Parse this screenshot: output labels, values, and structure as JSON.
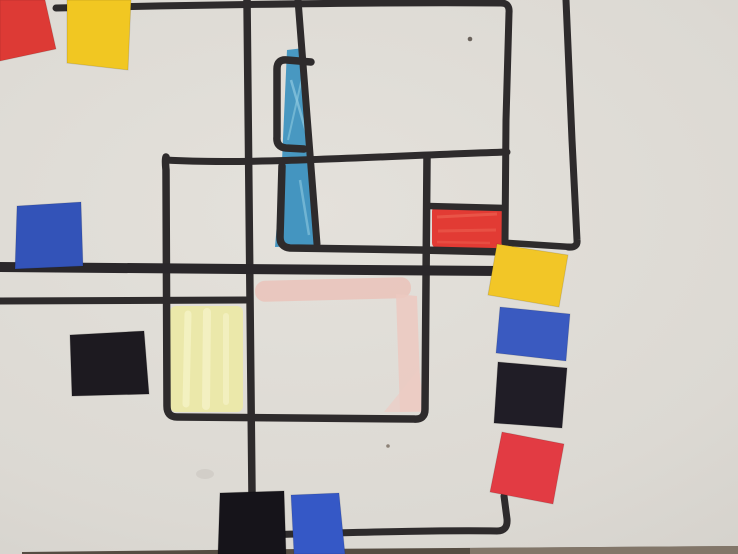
{
  "artwork": {
    "canvas": {
      "width": 738,
      "height": 554,
      "paper_base": "#dcd9d3",
      "vignette_edge": "#ccc9c3"
    },
    "palette": {
      "marker_line": "#2e2b2c",
      "paper_red": "#dd3a35",
      "paper_yellow": "#f1c722",
      "paper_blue": "#3353b8",
      "paper_black": "#1d1a20",
      "crayon_blue": "#3f93c0",
      "crayon_yellow": "#ebe8a6",
      "crayon_pink": "#eac4bb",
      "crayon_red": "#e1322b",
      "table_edge_dark": "#4e443a",
      "table_edge_light": "#8d8173"
    },
    "shapes": [
      {
        "name": "crayon-yellow-patch",
        "tag": "rect",
        "attrs": {
          "x": 170,
          "y": 306,
          "width": 73,
          "height": 106,
          "rx": 6,
          "fill": "#ebe8a6",
          "opacity": 0.92
        }
      },
      {
        "name": "crayon-yellow-streak",
        "tag": "path",
        "attrs": {
          "d": "M188,314 L186,404",
          "stroke": "#f5f2c6",
          "stroke-width": 7,
          "fill": "none",
          "opacity": 0.8,
          "stroke-linecap": "round"
        }
      },
      {
        "name": "crayon-yellow-streak",
        "tag": "path",
        "attrs": {
          "d": "M207,312 L206,406",
          "stroke": "#f6f3ca",
          "stroke-width": 8,
          "fill": "none",
          "opacity": 0.7,
          "stroke-linecap": "round"
        }
      },
      {
        "name": "crayon-yellow-streak",
        "tag": "path",
        "attrs": {
          "d": "M226,316 L226,402",
          "stroke": "#f5f2c6",
          "stroke-width": 6,
          "fill": "none",
          "opacity": 0.7,
          "stroke-linecap": "round"
        }
      },
      {
        "name": "crayon-blue-upper",
        "tag": "polygon",
        "attrs": {
          "points": "287,50 304,48 311,158 282,161",
          "fill": "#3f93c0",
          "opacity": 0.95
        }
      },
      {
        "name": "crayon-blue-lower",
        "tag": "polygon",
        "attrs": {
          "points": "282,163 312,161 320,245 275,247",
          "fill": "#3b90bf",
          "opacity": 0.95
        }
      },
      {
        "name": "crayon-blue-streak",
        "tag": "path",
        "attrs": {
          "d": "M291,80 L307,135",
          "stroke": "#8ec9e0",
          "stroke-width": 2.5,
          "fill": "none",
          "opacity": 0.7
        }
      },
      {
        "name": "crayon-blue-streak",
        "tag": "path",
        "attrs": {
          "d": "M305,65 L288,140",
          "stroke": "#8ec9e0",
          "stroke-width": 2,
          "fill": "none",
          "opacity": 0.6
        }
      },
      {
        "name": "crayon-blue-streak",
        "tag": "path",
        "attrs": {
          "d": "M300,180 L309,235",
          "stroke": "#8ec9e0",
          "stroke-width": 2.5,
          "fill": "none",
          "opacity": 0.6
        }
      },
      {
        "name": "crayon-pink-band",
        "tag": "rect",
        "attrs": {
          "x": 255,
          "y": 279,
          "width": 156,
          "height": 21,
          "rx": 10,
          "fill": "#eac4bb",
          "opacity": 0.9,
          "transform": "rotate(-1.5 333 289)"
        }
      },
      {
        "name": "crayon-pink-right-strip",
        "tag": "polygon",
        "attrs": {
          "points": "396,294 417,296 421,411 400,412",
          "fill": "#ecc9c1",
          "opacity": 0.85
        }
      },
      {
        "name": "crayon-pink-diagonal",
        "tag": "polygon",
        "attrs": {
          "points": "384,412 419,369 425,412",
          "fill": "#edccc4",
          "opacity": 0.7
        }
      },
      {
        "name": "crayon-red-patch",
        "tag": "rect",
        "attrs": {
          "x": 432,
          "y": 206,
          "width": 71,
          "height": 42,
          "rx": 5,
          "fill": "#e1322b",
          "opacity": 0.95
        }
      },
      {
        "name": "crayon-red-streak",
        "tag": "path",
        "attrs": {
          "d": "M437,217 L497,214",
          "stroke": "#ef6a58",
          "stroke-width": 3,
          "fill": "none",
          "opacity": 0.55
        }
      },
      {
        "name": "crayon-red-streak",
        "tag": "path",
        "attrs": {
          "d": "M438,231 L496,230",
          "stroke": "#ef6a58",
          "stroke-width": 3,
          "fill": "none",
          "opacity": 0.45
        }
      },
      {
        "name": "crayon-red-streak",
        "tag": "path",
        "attrs": {
          "d": "M437,242 L490,243",
          "stroke": "#ef6a58",
          "stroke-width": 2.5,
          "fill": "none",
          "opacity": 0.4
        }
      },
      {
        "name": "marker-top-border-and-right-vertical",
        "tag": "path",
        "attrs": {
          "d": "M56,8 C250,4 420,2 501,3 Q510,3 509,13 L506,120 L505,243",
          "stroke": "#2e2b2c",
          "stroke-width": 7,
          "fill": "none",
          "stroke-linecap": "round",
          "stroke-linejoin": "round"
        }
      },
      {
        "name": "marker-bottom-elbow-line",
        "tag": "path",
        "attrs": {
          "d": "M504,496 L507,519 Q508,531 497,531 C430,530 340,533 255,535",
          "stroke": "#2e2b2c",
          "stroke-width": 7,
          "fill": "none",
          "stroke-linecap": "round",
          "stroke-linejoin": "round"
        }
      },
      {
        "name": "marker-long-vertical-left",
        "tag": "path",
        "attrs": {
          "d": "M247,0 L252,494",
          "stroke": "#2e2b2c",
          "stroke-width": 7.5,
          "fill": "none",
          "stroke-linecap": "round"
        }
      },
      {
        "name": "marker-slanted-vertical-center",
        "tag": "path",
        "attrs": {
          "d": "M298,0 L317,244",
          "stroke": "#2e2b2c",
          "stroke-width": 7,
          "fill": "none",
          "stroke-linecap": "round"
        }
      },
      {
        "name": "marker-bracket-upper",
        "tag": "path",
        "attrs": {
          "d": "M311,62 L287,60 Q277,59 277,69 L277,137 Q276,147 286,148 L304,149",
          "stroke": "#2e2b2c",
          "stroke-width": 7.5,
          "fill": "none",
          "stroke-linecap": "round",
          "stroke-linejoin": "round"
        }
      },
      {
        "name": "marker-bracket-lower-and-mid-horizontal",
        "tag": "path",
        "attrs": {
          "d": "M282,166 L280,237 Q280,247 290,248 L420,250 L504,252",
          "stroke": "#2e2b2c",
          "stroke-width": 7.5,
          "fill": "none",
          "stroke-linecap": "round",
          "stroke-linejoin": "round"
        }
      },
      {
        "name": "marker-upper-horizontal",
        "tag": "path",
        "attrs": {
          "d": "M166,160 C250,165 380,156 507,152",
          "stroke": "#2e2b2c",
          "stroke-width": 7,
          "fill": "none",
          "stroke-linecap": "round"
        }
      },
      {
        "name": "marker-central-rectangle",
        "tag": "path",
        "attrs": {
          "d": "M166,157 Q165,160 166,170 L167,406 Q167,417 177,417 L414,419 Q425,420 425,409 L427,157",
          "stroke": "#2e2b2c",
          "stroke-width": 7.5,
          "fill": "none",
          "stroke-linecap": "round",
          "stroke-linejoin": "round"
        }
      },
      {
        "name": "marker-thick-middle-horizontal",
        "tag": "path",
        "attrs": {
          "d": "M0,267 L240,269 L499,271",
          "stroke": "#2a272a",
          "stroke-width": 10,
          "fill": "none",
          "stroke-linecap": "round"
        }
      },
      {
        "name": "marker-left-lower-horizontal",
        "tag": "path",
        "attrs": {
          "d": "M0,301 L246,300",
          "stroke": "#2e2b2c",
          "stroke-width": 7,
          "fill": "none",
          "stroke-linecap": "round"
        }
      },
      {
        "name": "marker-red-box-top",
        "tag": "path",
        "attrs": {
          "d": "M428,206 L505,208",
          "stroke": "#2e2b2c",
          "stroke-width": 6.5,
          "fill": "none",
          "stroke-linecap": "round"
        }
      },
      {
        "name": "marker-right-vertical",
        "tag": "path",
        "attrs": {
          "d": "M566,0 L572,140 L577,240 Q578,248 568,247",
          "stroke": "#2e2b2c",
          "stroke-width": 7,
          "fill": "none",
          "stroke-linecap": "round",
          "stroke-linejoin": "round"
        }
      },
      {
        "name": "marker-right-short-horizontal",
        "tag": "path",
        "attrs": {
          "d": "M509,243 L571,247",
          "stroke": "#2e2b2c",
          "stroke-width": 6.5,
          "fill": "none",
          "stroke-linecap": "round"
        }
      },
      {
        "name": "paper-speck",
        "tag": "circle",
        "attrs": {
          "cx": 470,
          "cy": 39,
          "r": 2.3,
          "fill": "#6b635c"
        }
      },
      {
        "name": "paper-speck",
        "tag": "circle",
        "attrs": {
          "cx": 388,
          "cy": 446,
          "r": 1.8,
          "fill": "#8d8277"
        }
      },
      {
        "name": "paper-smudge",
        "tag": "ellipse",
        "attrs": {
          "cx": 205,
          "cy": 474,
          "rx": 9,
          "ry": 5,
          "fill": "#cdc9c3",
          "opacity": 0.7
        }
      },
      {
        "name": "table-edge-band",
        "tag": "polygon",
        "attrs": {
          "points": "22,552 300,549 738,546 738,554 22,554",
          "fill": "#4e443a",
          "opacity": 0.95
        }
      },
      {
        "name": "table-edge-band-light",
        "tag": "polygon",
        "attrs": {
          "points": "470,548 738,546 738,554 470,554",
          "fill": "#8d8173",
          "opacity": 0.8
        }
      },
      {
        "name": "paper-square-red-top-left",
        "tag": "polygon",
        "attrs": {
          "points": "0,0 45,0 56,49 0,61",
          "fill": "#dd3a35",
          "stroke": "rgba(0,0,0,0.12)",
          "stroke-width": 1
        }
      },
      {
        "name": "paper-square-yellow-top-left",
        "tag": "polygon",
        "attrs": {
          "points": "67,0 131,0 128,70 67,63",
          "fill": "#f1c722",
          "stroke": "rgba(0,0,0,0.12)",
          "stroke-width": 1
        }
      },
      {
        "name": "paper-square-blue-left",
        "tag": "polygon",
        "attrs": {
          "points": "17,206 81,202 83,266 15,269",
          "fill": "#3353b8",
          "stroke": "rgba(0,0,0,0.12)",
          "stroke-width": 1
        }
      },
      {
        "name": "paper-square-black-middle-left",
        "tag": "polygon",
        "attrs": {
          "points": "70,335 144,331 149,394 72,396",
          "fill": "#1d1a20",
          "stroke": "rgba(0,0,0,0.2)",
          "stroke-width": 1
        }
      },
      {
        "name": "paper-square-yellow-right",
        "tag": "polygon",
        "attrs": {
          "points": "497,244 568,255 559,307 488,295",
          "fill": "#f2c627",
          "stroke": "rgba(0,0,0,0.12)",
          "stroke-width": 1
        }
      },
      {
        "name": "paper-square-blue-right",
        "tag": "polygon",
        "attrs": {
          "points": "500,307 570,314 566,361 496,353",
          "fill": "#3a5ac0",
          "stroke": "rgba(0,0,0,0.12)",
          "stroke-width": 1
        }
      },
      {
        "name": "paper-square-black-right",
        "tag": "polygon",
        "attrs": {
          "points": "498,362 567,368 562,428 494,423",
          "fill": "#201d26",
          "stroke": "rgba(0,0,0,0.2)",
          "stroke-width": 1
        }
      },
      {
        "name": "paper-square-red-right",
        "tag": "polygon",
        "attrs": {
          "points": "502,432 564,444 553,504 490,492",
          "fill": "#e23b43",
          "stroke": "rgba(0,0,0,0.12)",
          "stroke-width": 1
        }
      },
      {
        "name": "paper-square-black-bottom",
        "tag": "polygon",
        "attrs": {
          "points": "220,493 284,491 286,554 218,554",
          "fill": "#16141a",
          "stroke": "rgba(0,0,0,0.2)",
          "stroke-width": 1
        }
      },
      {
        "name": "paper-square-blue-bottom",
        "tag": "polygon",
        "attrs": {
          "points": "291,495 339,493 345,554 294,554",
          "fill": "#3558c6",
          "stroke": "rgba(0,0,0,0.12)",
          "stroke-width": 1
        }
      }
    ]
  }
}
